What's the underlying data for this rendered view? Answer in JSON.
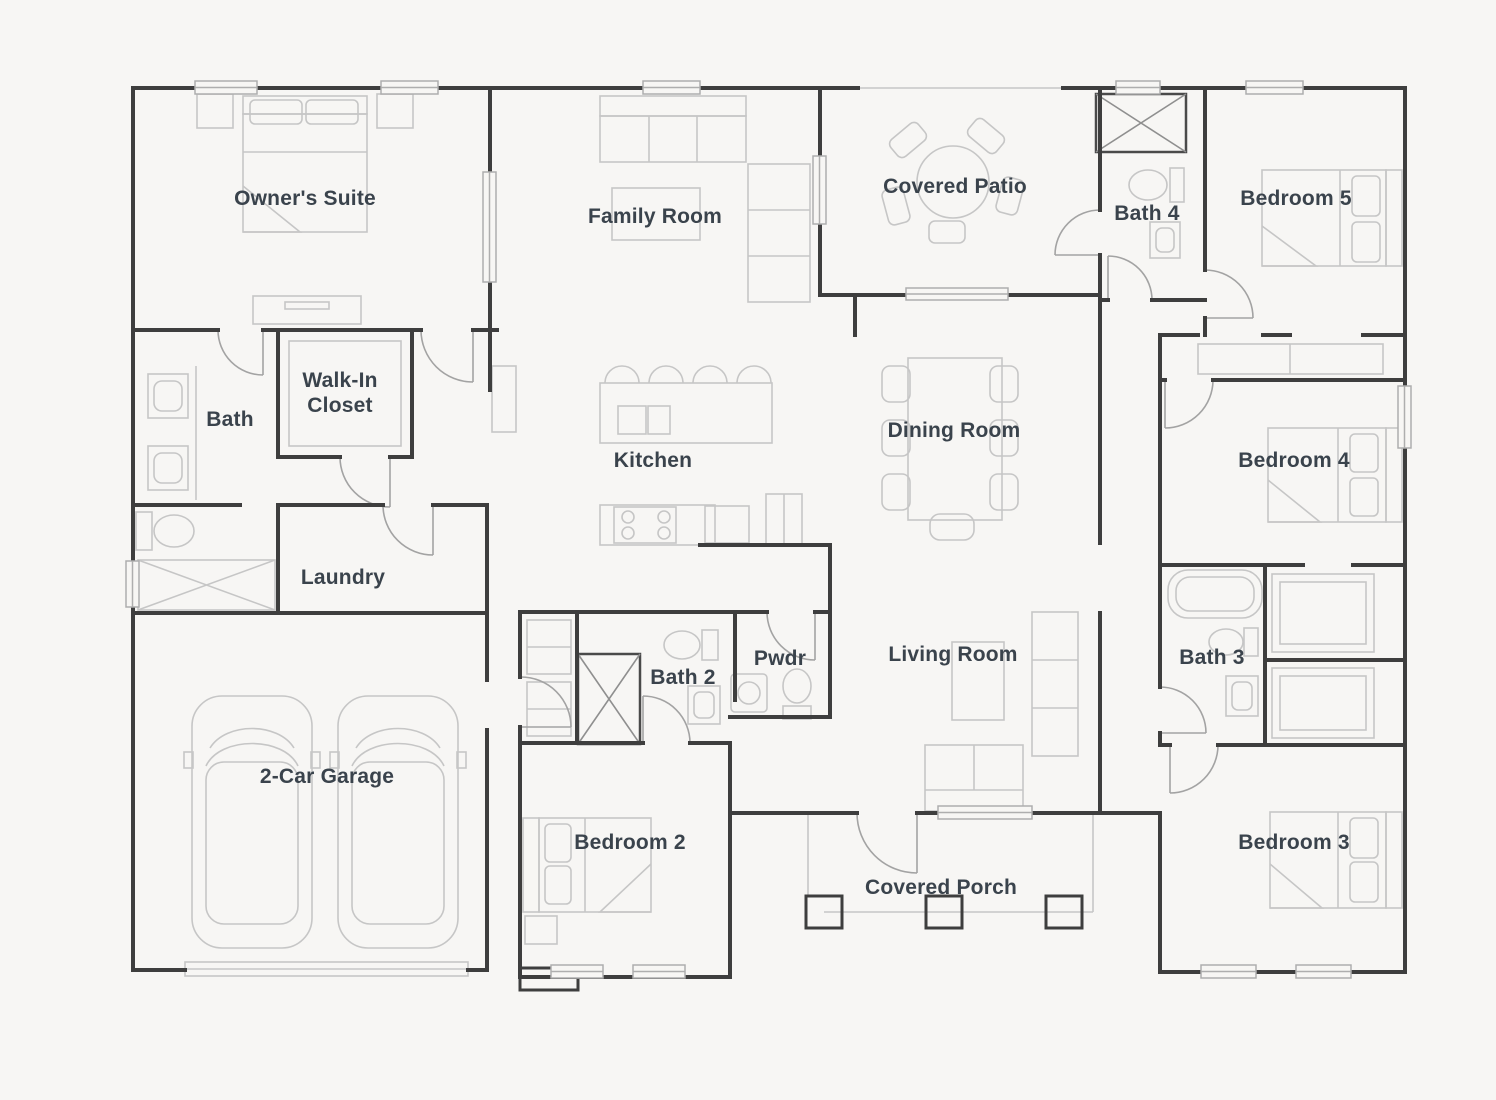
{
  "page": {
    "background": "#f7f6f4",
    "wall_color": "#3e3e3e",
    "furniture_color": "#c6c6c6",
    "door_color": "#a3a3a3",
    "window_border_color": "#aeaeae",
    "label_color": "#3a434c"
  },
  "floorplan": {
    "type": "single-story residence",
    "rooms": [
      {
        "id": "owners-suite",
        "label": "Owner's Suite"
      },
      {
        "id": "family-room",
        "label": "Family Room"
      },
      {
        "id": "covered-patio",
        "label": "Covered Patio"
      },
      {
        "id": "bath-4",
        "label": "Bath 4"
      },
      {
        "id": "bedroom-5",
        "label": "Bedroom 5"
      },
      {
        "id": "walk-in-closet",
        "label": "Walk-In Closet"
      },
      {
        "id": "bath",
        "label": "Bath"
      },
      {
        "id": "kitchen",
        "label": "Kitchen"
      },
      {
        "id": "dining-room",
        "label": "Dining Room"
      },
      {
        "id": "bedroom-4",
        "label": "Bedroom 4"
      },
      {
        "id": "laundry",
        "label": "Laundry"
      },
      {
        "id": "bath-2",
        "label": "Bath 2"
      },
      {
        "id": "pwdr",
        "label": "Pwdr"
      },
      {
        "id": "living-room",
        "label": "Living Room"
      },
      {
        "id": "bath-3",
        "label": "Bath 3"
      },
      {
        "id": "garage",
        "label": "2-Car Garage"
      },
      {
        "id": "bedroom-2",
        "label": "Bedroom 2"
      },
      {
        "id": "covered-porch",
        "label": "Covered Porch"
      },
      {
        "id": "bedroom-3",
        "label": "Bedroom 3"
      }
    ]
  }
}
